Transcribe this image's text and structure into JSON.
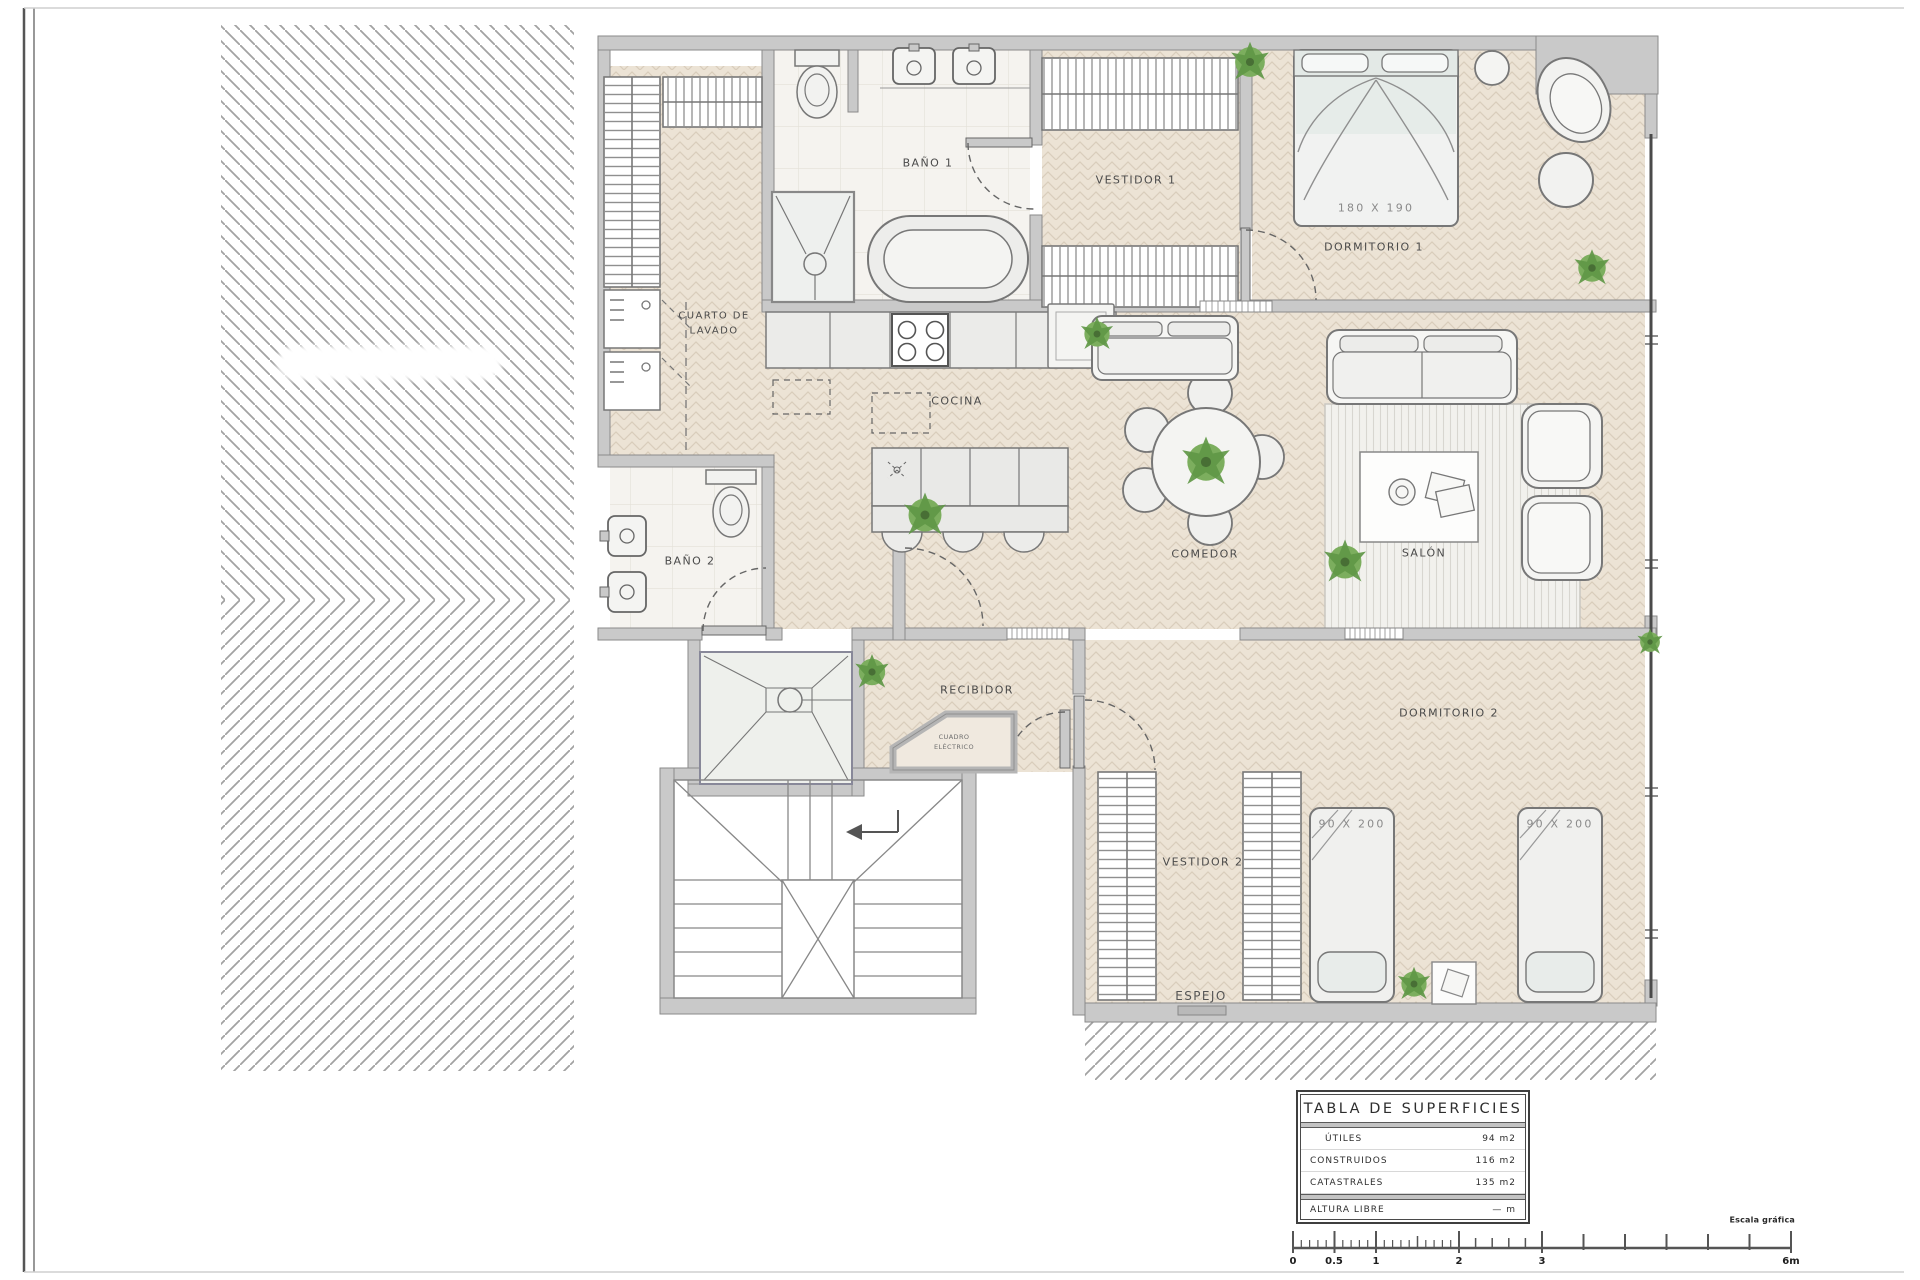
{
  "rooms": {
    "bano1": "BAÑO 1",
    "vestidor1": "VESTIDOR 1",
    "dormitorio1": "DORMITORIO 1",
    "cocina": "COCINA",
    "comedor": "COMEDOR",
    "salon": "SALÓN",
    "bano2": "BAÑO 2",
    "recibidor": "RECIBIDOR",
    "dormitorio2": "DORMITORIO 2",
    "vestidor2": "VESTIDOR 2",
    "espejo": "ESPEJO",
    "cuarto_lavado": [
      "CUARTO DE",
      "LAVADO"
    ],
    "cuadro_electrico": [
      "CUADRO",
      "ELÉCTRICO"
    ]
  },
  "dimensions": {
    "dorm1_bed": "180 X 190",
    "dorm2_bed_left": "90 X 200",
    "dorm2_bed_right": "90 X 200"
  },
  "surface_table": {
    "title": "TABLA DE SUPERFICIES",
    "rows": [
      {
        "label": "ÚTILES",
        "value": "94 m2"
      },
      {
        "label": "CONSTRUIDOS",
        "value": "116 m2"
      },
      {
        "label": "CATASTRALES",
        "value": "135 m2"
      }
    ],
    "footer": {
      "label": "ALTURA LIBRE",
      "value": "— m"
    }
  },
  "scale_bar": {
    "caption": "Escala gráfica",
    "tick_labels": [
      "0",
      "0.5",
      "1",
      "2",
      "3",
      "6m"
    ]
  },
  "colors": {
    "wall": "#c9c9c9",
    "floor_wood": "#ece3d5",
    "floor_tile": "#f5f3ef",
    "plant_green": "#76a85e",
    "line": "#7a7a7a"
  }
}
